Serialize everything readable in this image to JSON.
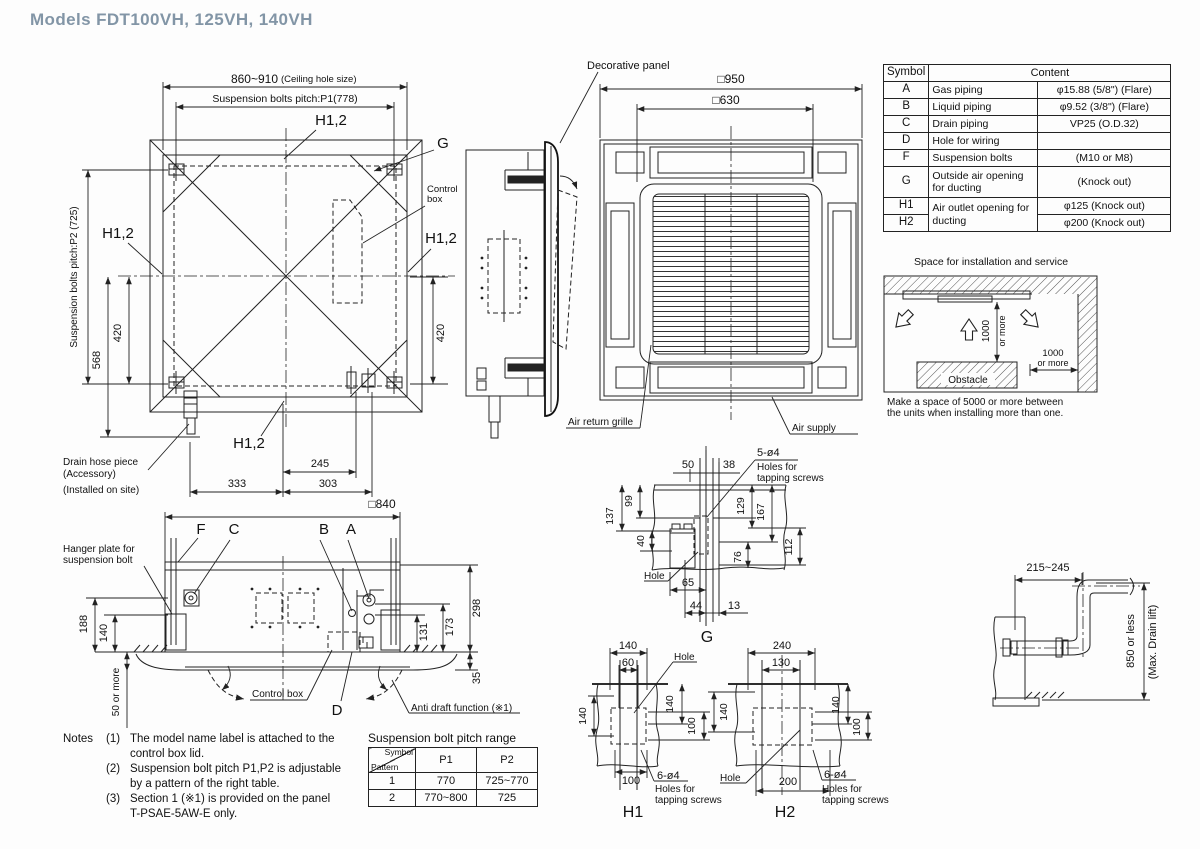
{
  "title": "Models  FDT100VH, 125VH, 140VH",
  "colors": {
    "accent_title": "#8295a6",
    "line": "#222222"
  },
  "plan": {
    "dim_ceiling": "860~910",
    "dim_ceiling_note": "(Ceiling hole size)",
    "dim_p1": "Suspension bolts pitch:P1(778)",
    "dim_p2": "Suspension bolts pitch:P2 (725)",
    "h12": "H1,2",
    "g": "G",
    "control_box_1": "Control",
    "control_box_2": "box",
    "d568": "568",
    "d420": "420",
    "d245": "245",
    "d333": "333",
    "d303": "303",
    "drain_1": "Drain hose piece",
    "drain_2": "(Accessory)",
    "drain_3": "(Installed on site)"
  },
  "panel": {
    "label": "Decorative panel",
    "d950": "□950",
    "d630": "□630",
    "air_return": "Air return grille",
    "air_supply": "Air supply"
  },
  "symbol_table": {
    "col_symbol": "Symbol",
    "col_content": "Content",
    "rows": [
      {
        "s": "A",
        "n": "Gas piping",
        "v": "φ15.88 (5/8\") (Flare)"
      },
      {
        "s": "B",
        "n": "Liquid piping",
        "v": "φ9.52 (3/8\") (Flare)"
      },
      {
        "s": "C",
        "n": "Drain piping",
        "v": "VP25 (O.D.32)"
      },
      {
        "s": "D",
        "n": "Hole for wiring",
        "v": ""
      },
      {
        "s": "F",
        "n": "Suspension bolts",
        "v": "(M10 or M8)"
      },
      {
        "s": "G",
        "n": "Outside air opening for ducting",
        "v": "(Knock out)"
      },
      {
        "s": "H1",
        "n": "Air outlet opening for ducting",
        "v": "φ125 (Knock out)"
      },
      {
        "s": "H2",
        "v": "φ200 (Knock out)"
      }
    ]
  },
  "install": {
    "title": "Space for installation and service",
    "v1000": "1000",
    "v1000b": "or more",
    "h1000": "1000",
    "h1000b": "or more",
    "obstacle": "Obstacle",
    "note1": "Make a space of 5000 or more between",
    "note2": "the units when installing more than one."
  },
  "side": {
    "d840": "□840",
    "f": "F",
    "c": "C",
    "b": "B",
    "a": "A",
    "d": "D",
    "hanger_1": "Hanger plate for",
    "hanger_2": "suspension bolt",
    "d188": "188",
    "d140": "140",
    "d50": "50 or more",
    "d298": "298",
    "d173": "173",
    "d131": "131",
    "d35": "35",
    "control_box": "Control box",
    "anti_draft": "Anti draft function (※1)"
  },
  "notes": {
    "label": "Notes",
    "items": [
      {
        "num": "(1)",
        "line1": "The model name label is attached to the",
        "line2": "control box lid."
      },
      {
        "num": "(2)",
        "line1": "Suspension bolt pitch P1,P2 is adjustable",
        "line2": "by a pattern of the right table."
      },
      {
        "num": "(3)",
        "line1": "Section 1 (※1) is provided on the panel",
        "line2": "T-PSAE-5AW-E only."
      }
    ]
  },
  "pitch_table": {
    "title": "Suspension bolt pitch range",
    "h_symbol": "Symbol",
    "h_pattern": "Pattern",
    "h_p1": "P1",
    "h_p2": "P2",
    "rows": [
      {
        "pattern": "1",
        "p1": "770",
        "p2": "725~770"
      },
      {
        "pattern": "2",
        "p1": "770~800",
        "p2": "725"
      }
    ]
  },
  "g_detail": {
    "label": "G",
    "screws": "5-ø4",
    "screws_2": "Holes for",
    "screws_3": "tapping screws",
    "hole": "Hole",
    "d50": "50",
    "d38": "38",
    "d99": "99",
    "d137": "137",
    "d40": "40",
    "d129": "129",
    "d167": "167",
    "d112": "112",
    "d76": "76",
    "d65": "65",
    "d44": "44",
    "d13": "13"
  },
  "h1_detail": {
    "label": "H1",
    "screws": "6-ø4",
    "screws_2": "Holes for",
    "screws_3": "tapping screws",
    "hole": "Hole",
    "d140t": "140",
    "d60": "60",
    "d140r": "140",
    "d100r": "100",
    "d140l": "140",
    "d100b": "100"
  },
  "h2_detail": {
    "label": "H2",
    "screws": "6-ø4",
    "screws_2": "Holes for",
    "screws_3": "tapping screws",
    "hole": "Hole",
    "d240": "240",
    "d130": "130",
    "d140r": "140",
    "d100r": "100",
    "d140l": "140",
    "d200": "200"
  },
  "drain_detail": {
    "d215": "215~245",
    "lift_1": "850 or less",
    "lift_2": "(Max. Drain lift)"
  }
}
